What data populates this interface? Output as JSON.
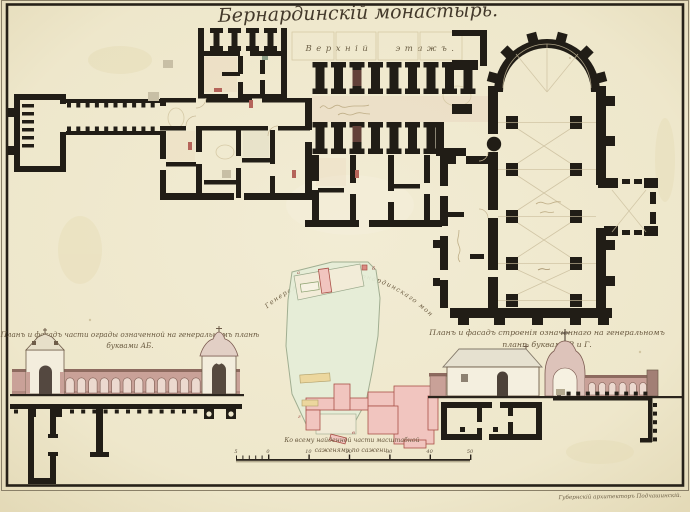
{
  "sheet": {
    "title": "Бернардинскій монастырь.",
    "floor_label": "Верхній этажъ.",
    "signature": "Губернскій архитекторъ Подчашинскій."
  },
  "left_elevation": {
    "caption_line1": "Планъ и фасадъ части ограды означенной на генеральномъ планѣ",
    "caption_line2": "буквами АБ."
  },
  "site_plan": {
    "arc_caption": "Генеральный планъ Бернардинскаго монастыря.",
    "markers": [
      "а",
      "б",
      "в",
      "г"
    ]
  },
  "right_elevation": {
    "caption_line1": "Планъ и фасадъ строенія означеннаго на генеральномъ",
    "caption_line2": "планѣ буквами В и Г."
  },
  "scale_bar": {
    "caption_line1": "Ко всему найденной части масштабной",
    "caption_line2": "саженями по сажени.",
    "sub_start_label": "5",
    "zero_label": "0",
    "major_labels": [
      "10",
      "20",
      "30",
      "40",
      "50"
    ]
  },
  "palette": {
    "paper": "#efe8cd",
    "ink": "#211d16",
    "arcade_pink": "#c9a198",
    "arch_fill": "#ecd9cf",
    "site_green": "#e6eed8",
    "site_pink": "#f1c5bf",
    "site_yellow": "#ecd79e",
    "accent_red": "#aa5148",
    "sepia": "#c9ba97"
  }
}
